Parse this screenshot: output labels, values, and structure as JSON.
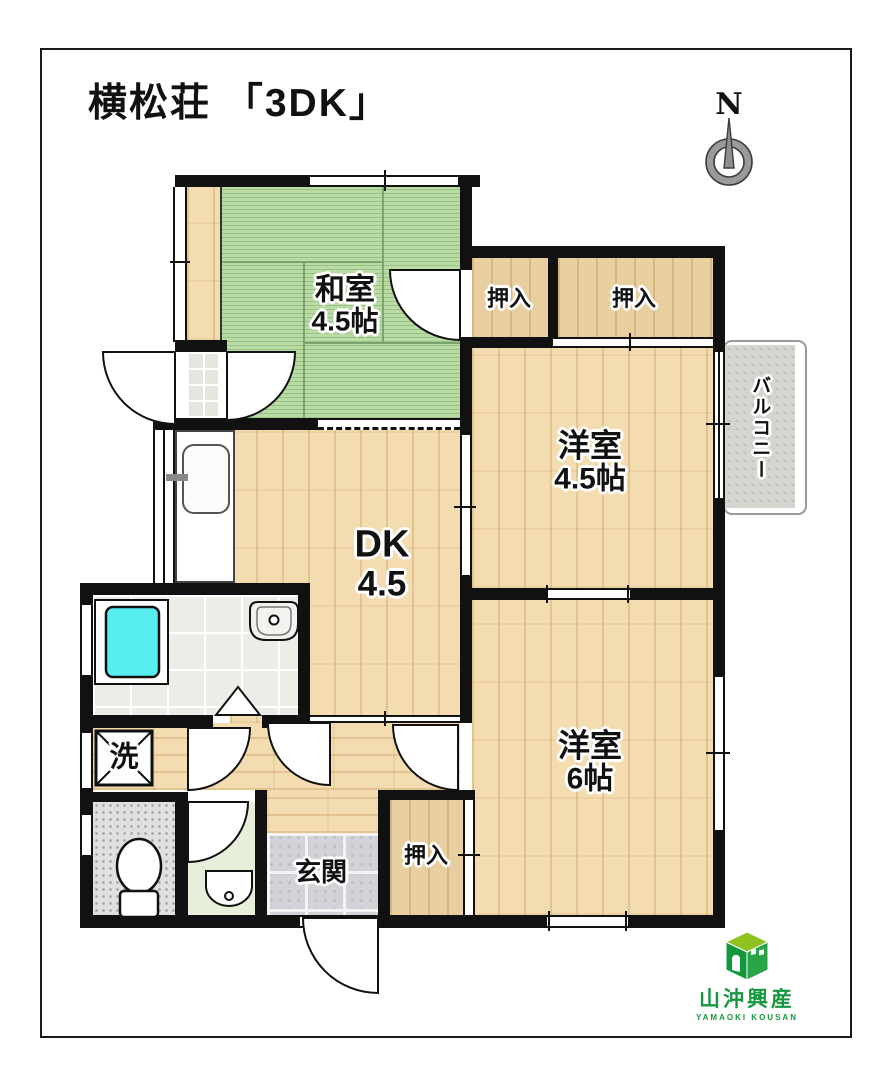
{
  "title": "横松荘 「3DK」",
  "compass": {
    "label": "N"
  },
  "rooms": {
    "washitsu": {
      "name": "和室",
      "size": "4.5帖"
    },
    "closet_top_left": {
      "label": "押入"
    },
    "closet_top_right": {
      "label": "押入"
    },
    "western_room_45": {
      "name": "洋室",
      "size": "4.5帖"
    },
    "balcony": {
      "label": "バルコニー"
    },
    "dk": {
      "name": "DK",
      "size": "4.5"
    },
    "western_room_6": {
      "name": "洋室",
      "size": "6帖"
    },
    "laundry": {
      "label": "洗"
    },
    "entrance": {
      "label": "玄関"
    },
    "closet_bottom": {
      "label": "押入"
    }
  },
  "logo": {
    "company": "山沖興産",
    "romaji": "YAMAOKI KOUSAN"
  },
  "colors": {
    "wall": "#111111",
    "tatami_green": "#b9dba4",
    "wood_floor": "#f3dcb0",
    "closet_wood": "#e7cf9f",
    "bathtub_cyan": "#58edf1",
    "balcony_gray": "#d5d5d0",
    "logo_green": "#15973f"
  }
}
